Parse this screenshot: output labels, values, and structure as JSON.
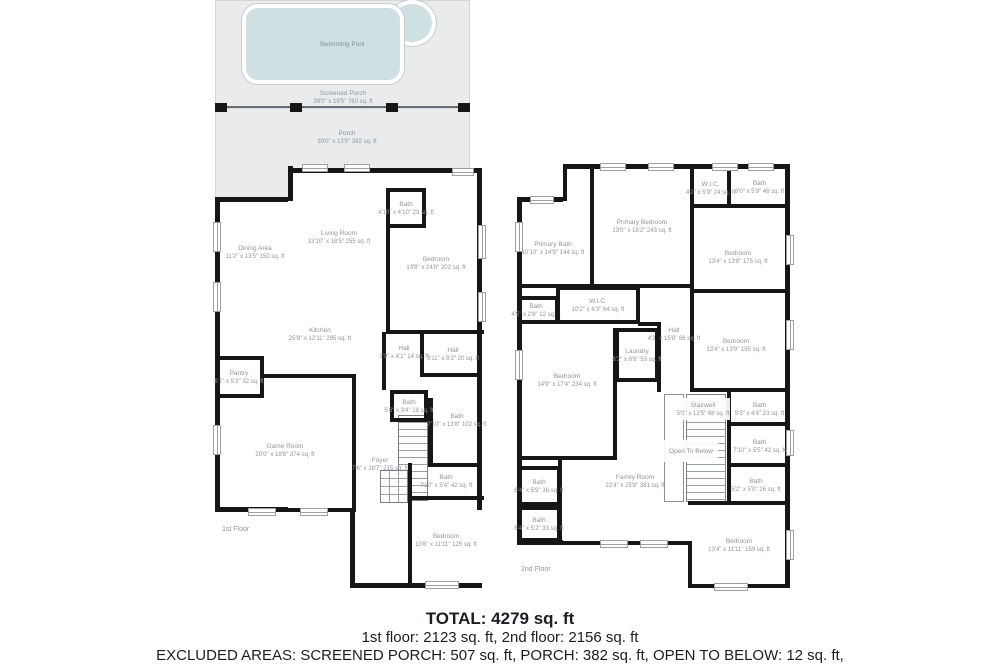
{
  "colors": {
    "wall": "#161616",
    "porch_fill": "#e9ebec",
    "pool_fill": "#cfe0e3",
    "room_label": "#8f959d",
    "summary_text": "#1a1d22"
  },
  "outdoor": {
    "pool": {
      "name": "Swimming Pool"
    },
    "screened_porch": {
      "name": "Screened Porch",
      "dims": "39'0\" x 19'5\" 760 sq. ft"
    },
    "porch": {
      "name": "Porch",
      "dims": "39'0\" x 13'5\" 382 sq. ft"
    }
  },
  "floors": [
    {
      "label": "1st Floor",
      "footprints": [
        [
          215,
          197,
          77,
          315,
          "ltb"
        ],
        [
          288,
          168,
          194,
          420,
          "tr"
        ],
        [
          350,
          510,
          132,
          78,
          "lb"
        ]
      ],
      "walls": [
        [
          288,
          166,
          5,
          35
        ],
        [
          386,
          228,
          4,
          104
        ],
        [
          386,
          330,
          98,
          4
        ],
        [
          420,
          332,
          4,
          44
        ],
        [
          382,
          332,
          4,
          58
        ],
        [
          262,
          374,
          92,
          4
        ],
        [
          352,
          374,
          4,
          138
        ],
        [
          288,
          508,
          68,
          4
        ],
        [
          420,
          373,
          62,
          4
        ],
        [
          428,
          398,
          5,
          68
        ],
        [
          428,
          463,
          54,
          4
        ],
        [
          408,
          463,
          4,
          37
        ],
        [
          408,
          496,
          76,
          4
        ],
        [
          408,
          500,
          4,
          84
        ]
      ],
      "rails": [],
      "stairs": [
        [
          398,
          415,
          30,
          86,
          "v"
        ],
        [
          380,
          470,
          28,
          33,
          "g"
        ]
      ],
      "windows": [
        [
          302,
          164,
          26,
          8
        ],
        [
          344,
          164,
          26,
          8
        ],
        [
          452,
          168,
          22,
          8
        ],
        [
          478,
          225,
          8,
          34
        ],
        [
          478,
          292,
          8,
          30
        ],
        [
          213,
          222,
          8,
          30
        ],
        [
          213,
          282,
          8,
          30
        ],
        [
          213,
          425,
          8,
          30
        ],
        [
          248,
          508,
          28,
          8
        ],
        [
          300,
          508,
          28,
          8
        ],
        [
          425,
          581,
          34,
          8
        ]
      ],
      "rooms": [
        {
          "n": "Dining Area",
          "d": "11'2\" x 13'5\" 150 sq. ft",
          "b": [
            218,
            200,
            74,
            105
          ]
        },
        {
          "n": "Living Room",
          "d": "13'10\" x 18'5\" 255 sq. ft",
          "b": [
            293,
            172,
            92,
            130
          ]
        },
        {
          "n": "Bath",
          "d": "4'10\" x 4'10\" 23 sq. ft",
          "b": [
            386,
            188,
            40,
            40
          ],
          "s": "trbl"
        },
        {
          "n": "Bedroom",
          "d": "13'8\" x 24'8\" 202 sq. ft",
          "b": [
            390,
            215,
            92,
            96
          ]
        },
        {
          "n": "Kitchen",
          "d": "25'8\" x 12'11\" 295 sq. ft",
          "b": [
            230,
            300,
            180,
            68
          ]
        },
        {
          "n": "Pantry",
          "d": "6'1\" x 5'3\" 32 sq. ft",
          "b": [
            218,
            356,
            46,
            42
          ],
          "s": "trb"
        },
        {
          "n": "Hall",
          "d": "3'9\" x 4'1\" 14 sq. ft",
          "b": [
            386,
            332,
            36,
            40
          ]
        },
        {
          "n": "Hall",
          "d": "3'11\" x 5'2\" 20 sq. ft",
          "b": [
            424,
            332,
            58,
            44
          ]
        },
        {
          "n": "Bath",
          "d": "5'6\" x 3'4\" 18 sq. ft",
          "b": [
            390,
            390,
            38,
            32
          ],
          "s": "trbl"
        },
        {
          "n": "Bath",
          "d": "7'10\" x 13'8\" 102 sq. ft",
          "b": [
            432,
            377,
            50,
            86
          ]
        },
        {
          "n": "Game Room",
          "d": "20'0\" x 18'8\" 374 sq. ft",
          "b": [
            218,
            400,
            134,
            100
          ]
        },
        {
          "n": "Foyer",
          "d": "7'6\" x 28'7\" 215 sq. ft",
          "b": [
            354,
            430,
            52,
            68
          ]
        },
        {
          "n": "Bath",
          "d": "7'10\" x 5'4\" 42 sq. ft",
          "b": [
            412,
            466,
            68,
            30
          ]
        },
        {
          "n": "Bedroom",
          "d": "10'6\" x 11'11\" 125 sq. ft",
          "b": [
            412,
            500,
            68,
            80
          ]
        }
      ]
    },
    {
      "label": "2nd Floor",
      "footprints": [
        [
          517,
          197,
          50,
          348,
          "ltb"
        ],
        [
          563,
          164,
          227,
          424,
          "tr"
        ]
      ],
      "walls": [
        [
          563,
          164,
          4,
          37
        ],
        [
          590,
          168,
          4,
          118
        ],
        [
          517,
          284,
          176,
          4
        ],
        [
          690,
          164,
          4,
          228
        ],
        [
          727,
          166,
          4,
          40
        ],
        [
          690,
          204,
          100,
          4
        ],
        [
          690,
          289,
          100,
          4
        ],
        [
          690,
          388,
          100,
          4
        ],
        [
          657,
          322,
          4,
          70
        ],
        [
          638,
          322,
          22,
          4
        ],
        [
          517,
          456,
          100,
          4
        ],
        [
          613,
          328,
          4,
          132
        ],
        [
          558,
          460,
          4,
          84
        ],
        [
          563,
          541,
          129,
          4
        ],
        [
          688,
          541,
          4,
          47
        ],
        [
          688,
          584,
          102,
          4
        ],
        [
          688,
          501,
          102,
          4
        ],
        [
          727,
          392,
          4,
          112
        ],
        [
          727,
          422,
          61,
          4
        ],
        [
          727,
          463,
          61,
          4
        ]
      ],
      "rails": [
        [
          664,
          394,
          20,
          108
        ]
      ],
      "stairs": [
        [
          686,
          394,
          40,
          108,
          "v"
        ]
      ],
      "windows": [
        [
          600,
          163,
          26,
          8
        ],
        [
          648,
          163,
          26,
          8
        ],
        [
          712,
          163,
          26,
          8
        ],
        [
          748,
          163,
          26,
          8
        ],
        [
          530,
          196,
          24,
          8
        ],
        [
          515,
          222,
          8,
          30
        ],
        [
          515,
          350,
          8,
          30
        ],
        [
          786,
          235,
          8,
          30
        ],
        [
          786,
          320,
          8,
          30
        ],
        [
          786,
          430,
          8,
          26
        ],
        [
          786,
          530,
          8,
          30
        ],
        [
          600,
          540,
          28,
          8
        ],
        [
          640,
          540,
          28,
          8
        ],
        [
          714,
          583,
          34,
          8
        ]
      ],
      "rooms": [
        {
          "n": "Primary Bath",
          "d": "10'10\" x 14'9\" 144 sq. ft",
          "b": [
            517,
            206,
            72,
            84
          ]
        },
        {
          "n": "Primary Bedroom",
          "d": "13'0\" x 16'2\" 243 sq. ft",
          "b": [
            594,
            168,
            96,
            116
          ]
        },
        {
          "n": "W.I.C.",
          "d": "4'2\" x 5'9\" 24 sq. ft",
          "b": [
            694,
            170,
            33,
            36
          ]
        },
        {
          "n": "Bath",
          "d": "8'0\" x 5'9\" 46 sq. ft",
          "b": [
            731,
            170,
            57,
            34
          ]
        },
        {
          "n": "Bedroom",
          "d": "13'4\" x 13'9\" 175 sq. ft",
          "b": [
            690,
            214,
            96,
            86
          ]
        },
        {
          "n": "Bath",
          "d": "4'5\" x 2'8\" 12 sq. ft",
          "b": [
            517,
            296,
            42,
            28
          ],
          "s": "trb"
        },
        {
          "n": "W.I.C.",
          "d": "10'2\" x 6'3\" 64 sq. ft",
          "b": [
            556,
            286,
            84,
            38
          ],
          "s": "trbl"
        },
        {
          "n": "Hall",
          "d": "4'3\" x 15'8\" 66 sq. ft",
          "b": [
            657,
            316,
            34,
            36
          ]
        },
        {
          "n": "Laundry",
          "d": "6'2\" x 8'6\" 53 sq. ft",
          "b": [
            615,
            328,
            44,
            54
          ],
          "s": "trbl"
        },
        {
          "n": "Bedroom",
          "d": "14'9\" x 17'4\" 234 sq. ft",
          "b": [
            519,
            330,
            96,
            100
          ]
        },
        {
          "n": "Bedroom",
          "d": "13'4\" x 13'9\" 185 sq. ft",
          "b": [
            690,
            297,
            92,
            96
          ]
        },
        {
          "n": "Stairwell",
          "d": "5'0\" x 13'5\" 68 sq. ft",
          "b": [
            676,
            398,
            54,
            22
          ],
          "bg": 1
        },
        {
          "n": "Open To Below",
          "d": "",
          "b": [
            664,
            440,
            54,
            22
          ],
          "bg": 1
        },
        {
          "n": "Bath",
          "d": "5'3\" x 4'4\" 23 sq. ft",
          "b": [
            731,
            394,
            57,
            30
          ]
        },
        {
          "n": "Bath",
          "d": "7'10\" x 5'5\" 42 sq. ft",
          "b": [
            731,
            428,
            57,
            36
          ]
        },
        {
          "n": "Bath",
          "d": "5'2\" x 5'0\" 26 sq. ft",
          "b": [
            731,
            467,
            50,
            36
          ]
        },
        {
          "n": "Family Room",
          "d": "22'4\" x 25'8\" 381 sq. ft",
          "b": [
            572,
            424,
            126,
            114
          ]
        },
        {
          "n": "Bath",
          "d": "6'4\" x 5'9\" 36 sq. ft",
          "b": [
            517,
            466,
            44,
            40
          ],
          "s": "trbl"
        },
        {
          "n": "Bath",
          "d": "6'4\" x 5'2\" 33 sq. ft",
          "b": [
            517,
            506,
            44,
            36
          ],
          "s": "trbl"
        },
        {
          "n": "Bedroom",
          "d": "13'4\" x 11'11\" 159 sq. ft",
          "b": [
            690,
            505,
            98,
            80
          ]
        }
      ]
    }
  ],
  "summary": {
    "total": "TOTAL: 4279 sq. ft",
    "floors_line": "1st floor: 2123 sq. ft, 2nd floor: 2156 sq. ft",
    "excluded_line1": "EXCLUDED AREAS: SCREENED PORCH: 507 sq. ft, PORCH: 382 sq. ft, OPEN TO BELOW: 12 sq. ft,",
    "excluded_line2": "STAIRWELL: 68 sq. ft, WALLS: 254 sq. ft"
  }
}
